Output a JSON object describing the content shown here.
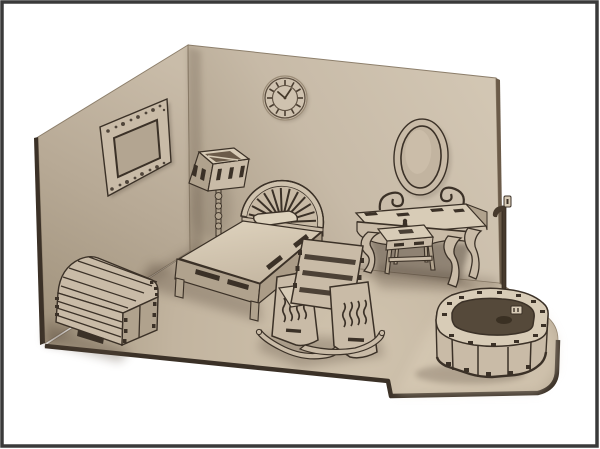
{
  "scene": {
    "label": "3d-render-laser-cut-dollhouse-bedroom-furniture-set",
    "objects": [
      {
        "name": "left-wall"
      },
      {
        "name": "back-wall"
      },
      {
        "name": "wall-clock"
      },
      {
        "name": "ornate-picture-frame"
      },
      {
        "name": "floor-lamp"
      },
      {
        "name": "single-bed-with-fan-headboard"
      },
      {
        "name": "storage-chest"
      },
      {
        "name": "vanity-table-with-oval-mirror"
      },
      {
        "name": "vanity-stool"
      },
      {
        "name": "rocking-chair"
      },
      {
        "name": "bathtub-with-shower-stand"
      },
      {
        "name": "floor-base-board"
      }
    ],
    "colors": {
      "background": "#ffffff",
      "frame_border": "#3a3a3a",
      "wall_light": "#d3c7b4",
      "wall_mid": "#c7baa7",
      "wall_dark": "#a3957f",
      "floor_light": "#d6c9b4",
      "floor_mid": "#c3b5a1",
      "floor_dark": "#a2947e",
      "wood_top": "#d8ccb7",
      "wood_face": "#c9bba7",
      "wood_side": "#b0a28d",
      "edge_dark": "#3b3127",
      "cut_shadow": "#5a4c3c",
      "tub_interior": "#55493a"
    }
  }
}
